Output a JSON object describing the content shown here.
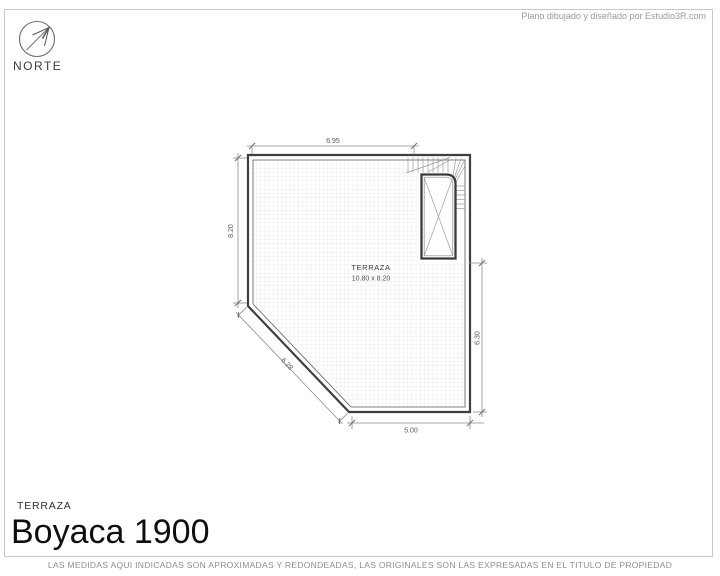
{
  "page": {
    "credit": "Plano dibujado y diseñado por Estudio3R.com",
    "footer_disclaimer": "LAS MEDIDAS AQUI INDICADAS SON APROXIMADAS Y REDONDEADAS, LAS ORIGINALES SON LAS EXPRESADAS EN EL TITULO DE PROPIEDAD"
  },
  "compass": {
    "label": "NORTE"
  },
  "title_block": {
    "plan_type": "TERRAZA",
    "title": "Boyaca 1900"
  },
  "plan": {
    "room": {
      "name": "TERRAZA",
      "size": "10.80 x 8.20"
    },
    "dimensions": {
      "top": "6.95",
      "left": "8.20",
      "right": "6.30",
      "bottom": "5.00",
      "diagonal": "6.28"
    }
  },
  "colors": {
    "wall_line": "#3f3f3f",
    "dim_line": "#8c8c8c",
    "grid_line": "#e3e3e3",
    "muted_text": "#9a9a9a"
  }
}
